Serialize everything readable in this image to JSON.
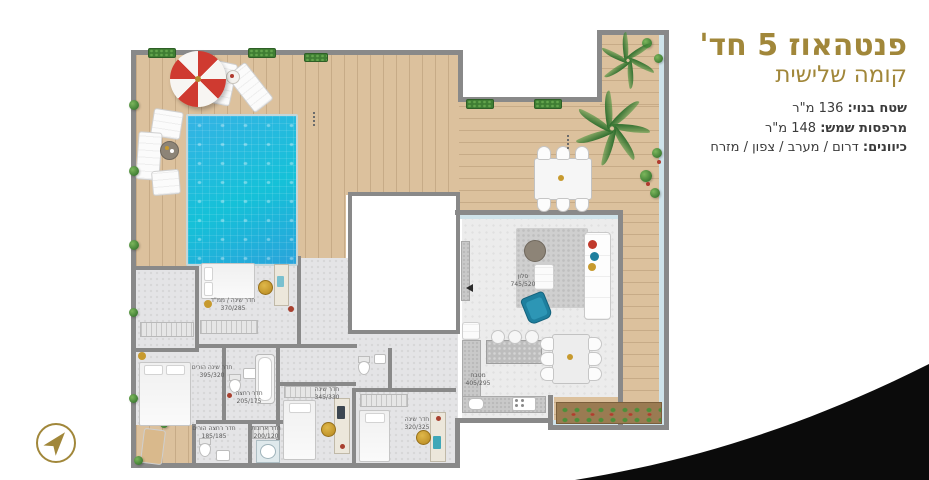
{
  "header": {
    "title": "פנטהאוז 5 חד'",
    "subtitle": "קומה שלישית",
    "details": [
      {
        "label": "שטח בנוי:",
        "value": "136 מ\"ר"
      },
      {
        "label": "מרפסות שמש:",
        "value": "148 מ\"ר"
      },
      {
        "label": "כיוונים:",
        "value": "דרום / מערב / צפון / מזרח"
      }
    ]
  },
  "plan": {
    "rooms": [
      {
        "id": "living-room",
        "name": "סלון",
        "dims": "745/520"
      },
      {
        "id": "kitchen",
        "name": "מטבח",
        "dims": "405/295"
      },
      {
        "id": "mamad-bedroom",
        "name": "חדר שינה / ממ\"ד",
        "dims": "370/285"
      },
      {
        "id": "master-bedroom",
        "name": "חדר שינה הורים",
        "dims": "395/320"
      },
      {
        "id": "bathroom",
        "name": "חדר רחצה",
        "dims": "205/175"
      },
      {
        "id": "master-bathroom",
        "name": "חדר רחצה הורים",
        "dims": "185/185"
      },
      {
        "id": "closet-room",
        "name": "חדר ארונות",
        "dims": "200/120"
      },
      {
        "id": "bedroom-3",
        "name": "חדר שינה",
        "dims": "345/330"
      },
      {
        "id": "bedroom-4",
        "name": "חדר שינה",
        "dims": "320/325"
      }
    ],
    "colors": {
      "accent_gold": "#a1873a",
      "pool_blue": "#2bb0e3",
      "deck_wood": "#dcc19d",
      "wall_gray": "#898989",
      "swoosh_black": "#0b0b0b"
    }
  }
}
